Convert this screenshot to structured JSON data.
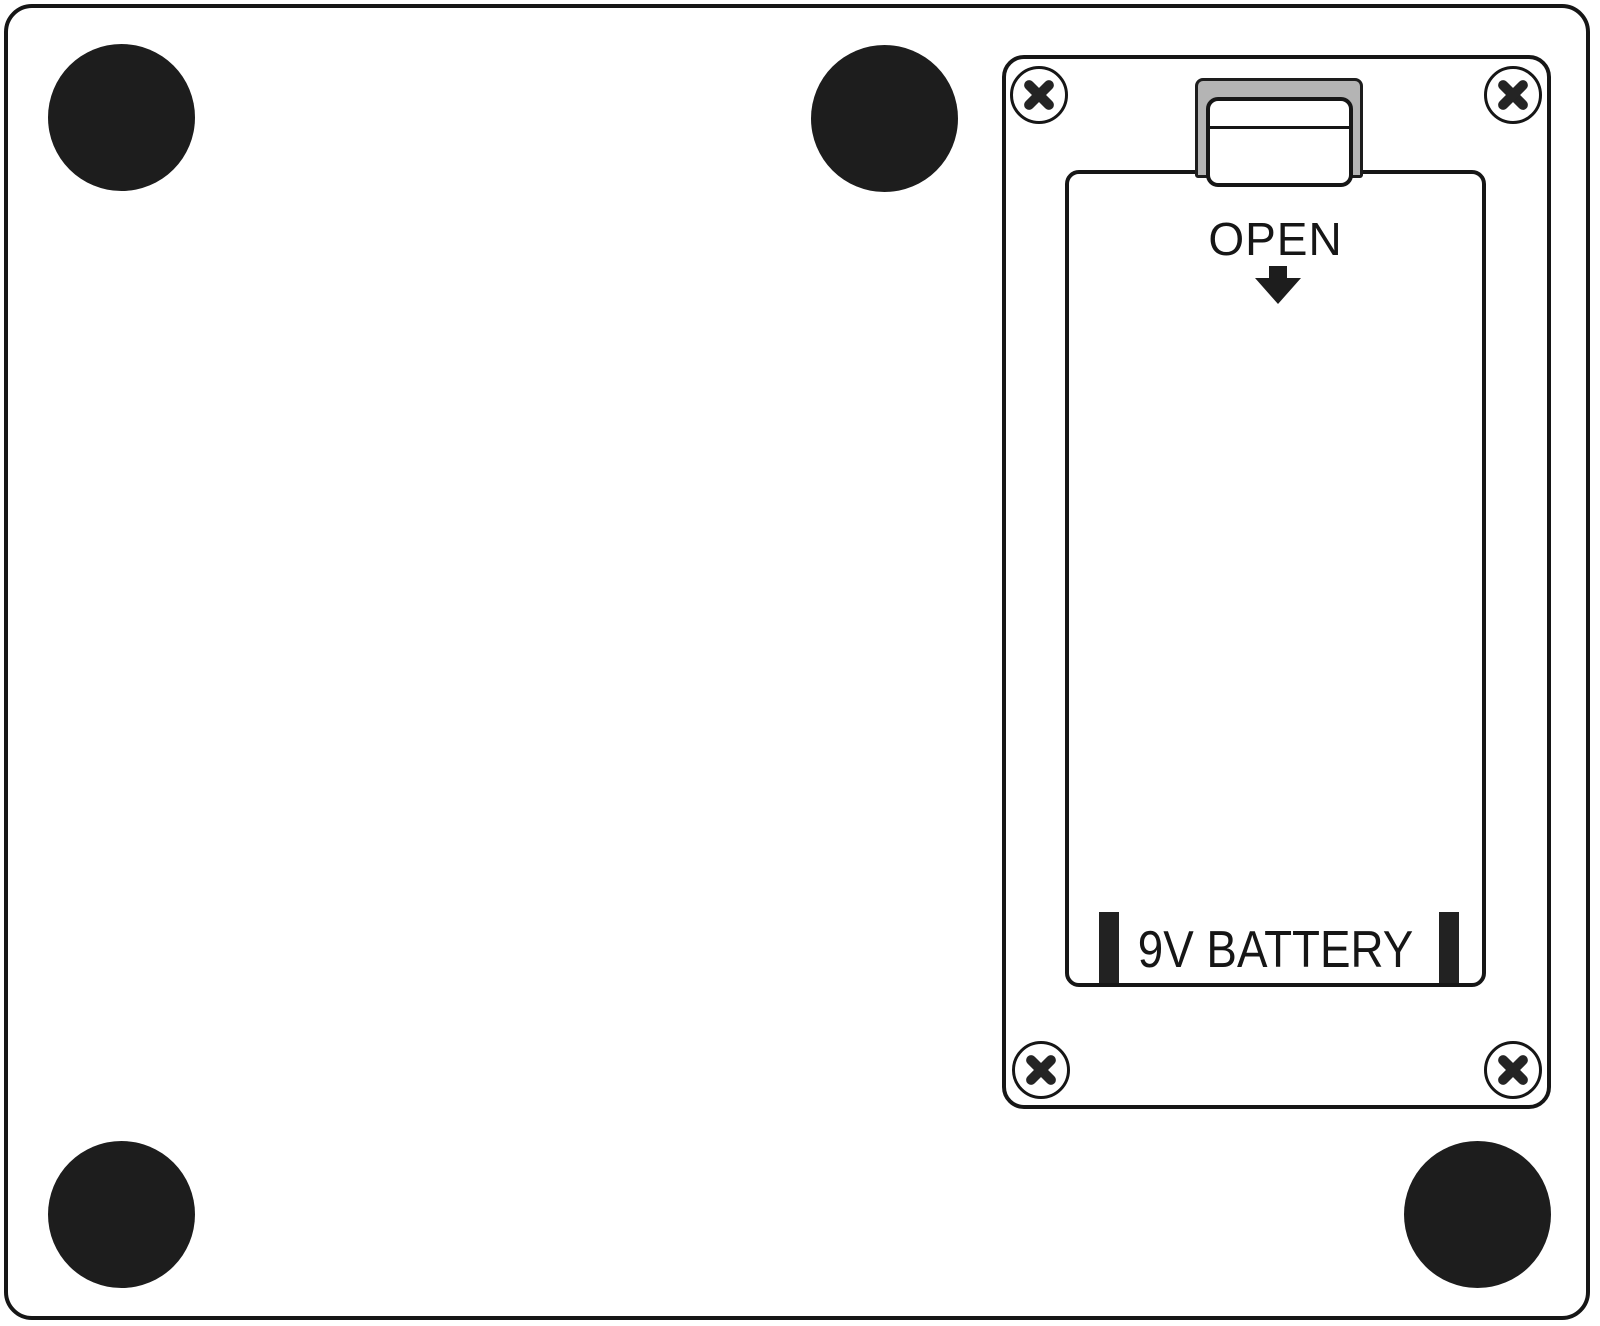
{
  "figure": {
    "kind": "device-back-panel-line-diagram",
    "battery_compartment": {
      "open_label": "OPEN",
      "battery_label": "9V BATTERY",
      "screw_count": 4
    },
    "feet_count": 4,
    "icons": {
      "screw": "circled-x",
      "open_direction": "arrow-down",
      "battery_contacts": "vertical-bars"
    },
    "colors": {
      "line": "#161616",
      "latch_gray": "#b4b4b4",
      "foot": "#1d1d1d",
      "background": "#ffffff"
    }
  }
}
